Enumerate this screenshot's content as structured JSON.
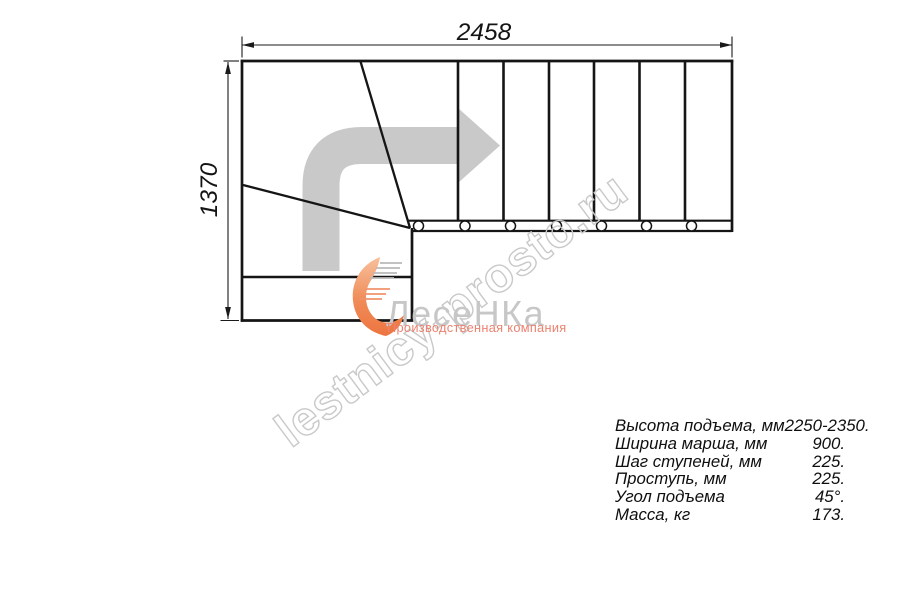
{
  "drawing": {
    "title": "L-shaped staircase plan, top view",
    "dimension_width": "2458",
    "dimension_height": "1370",
    "watermark": "lestnicy-prosto.ru",
    "logo": {
      "name": "ЛесеНКа",
      "subtitle": "Производственная компания"
    },
    "colors": {
      "line": "#151515",
      "direction_arrow_gray": "#c9c9c9",
      "watermark_gray": "#c9c9c9",
      "logo_flame_orange": "#ee7440",
      "logo_name_gray": "#c7c7c7",
      "logo_subtitle_orange": "#ed8270"
    },
    "icons": {
      "direction_arrow": "turn-right-arrow-icon",
      "fasteners": "bolt-circle-icon",
      "logo": "flame-swoosh-icon"
    }
  },
  "specs": {
    "rows": [
      {
        "label": "Высота подъема, мм",
        "value": "2250-2350."
      },
      {
        "label": "Ширина марша, мм",
        "value": "900."
      },
      {
        "label": "Шаг ступеней, мм",
        "value": "225."
      },
      {
        "label": "Проступь, мм",
        "value": "225."
      },
      {
        "label": "Угол подъема",
        "value": "45°."
      },
      {
        "label": "Масса, кг",
        "value": "173."
      }
    ]
  }
}
